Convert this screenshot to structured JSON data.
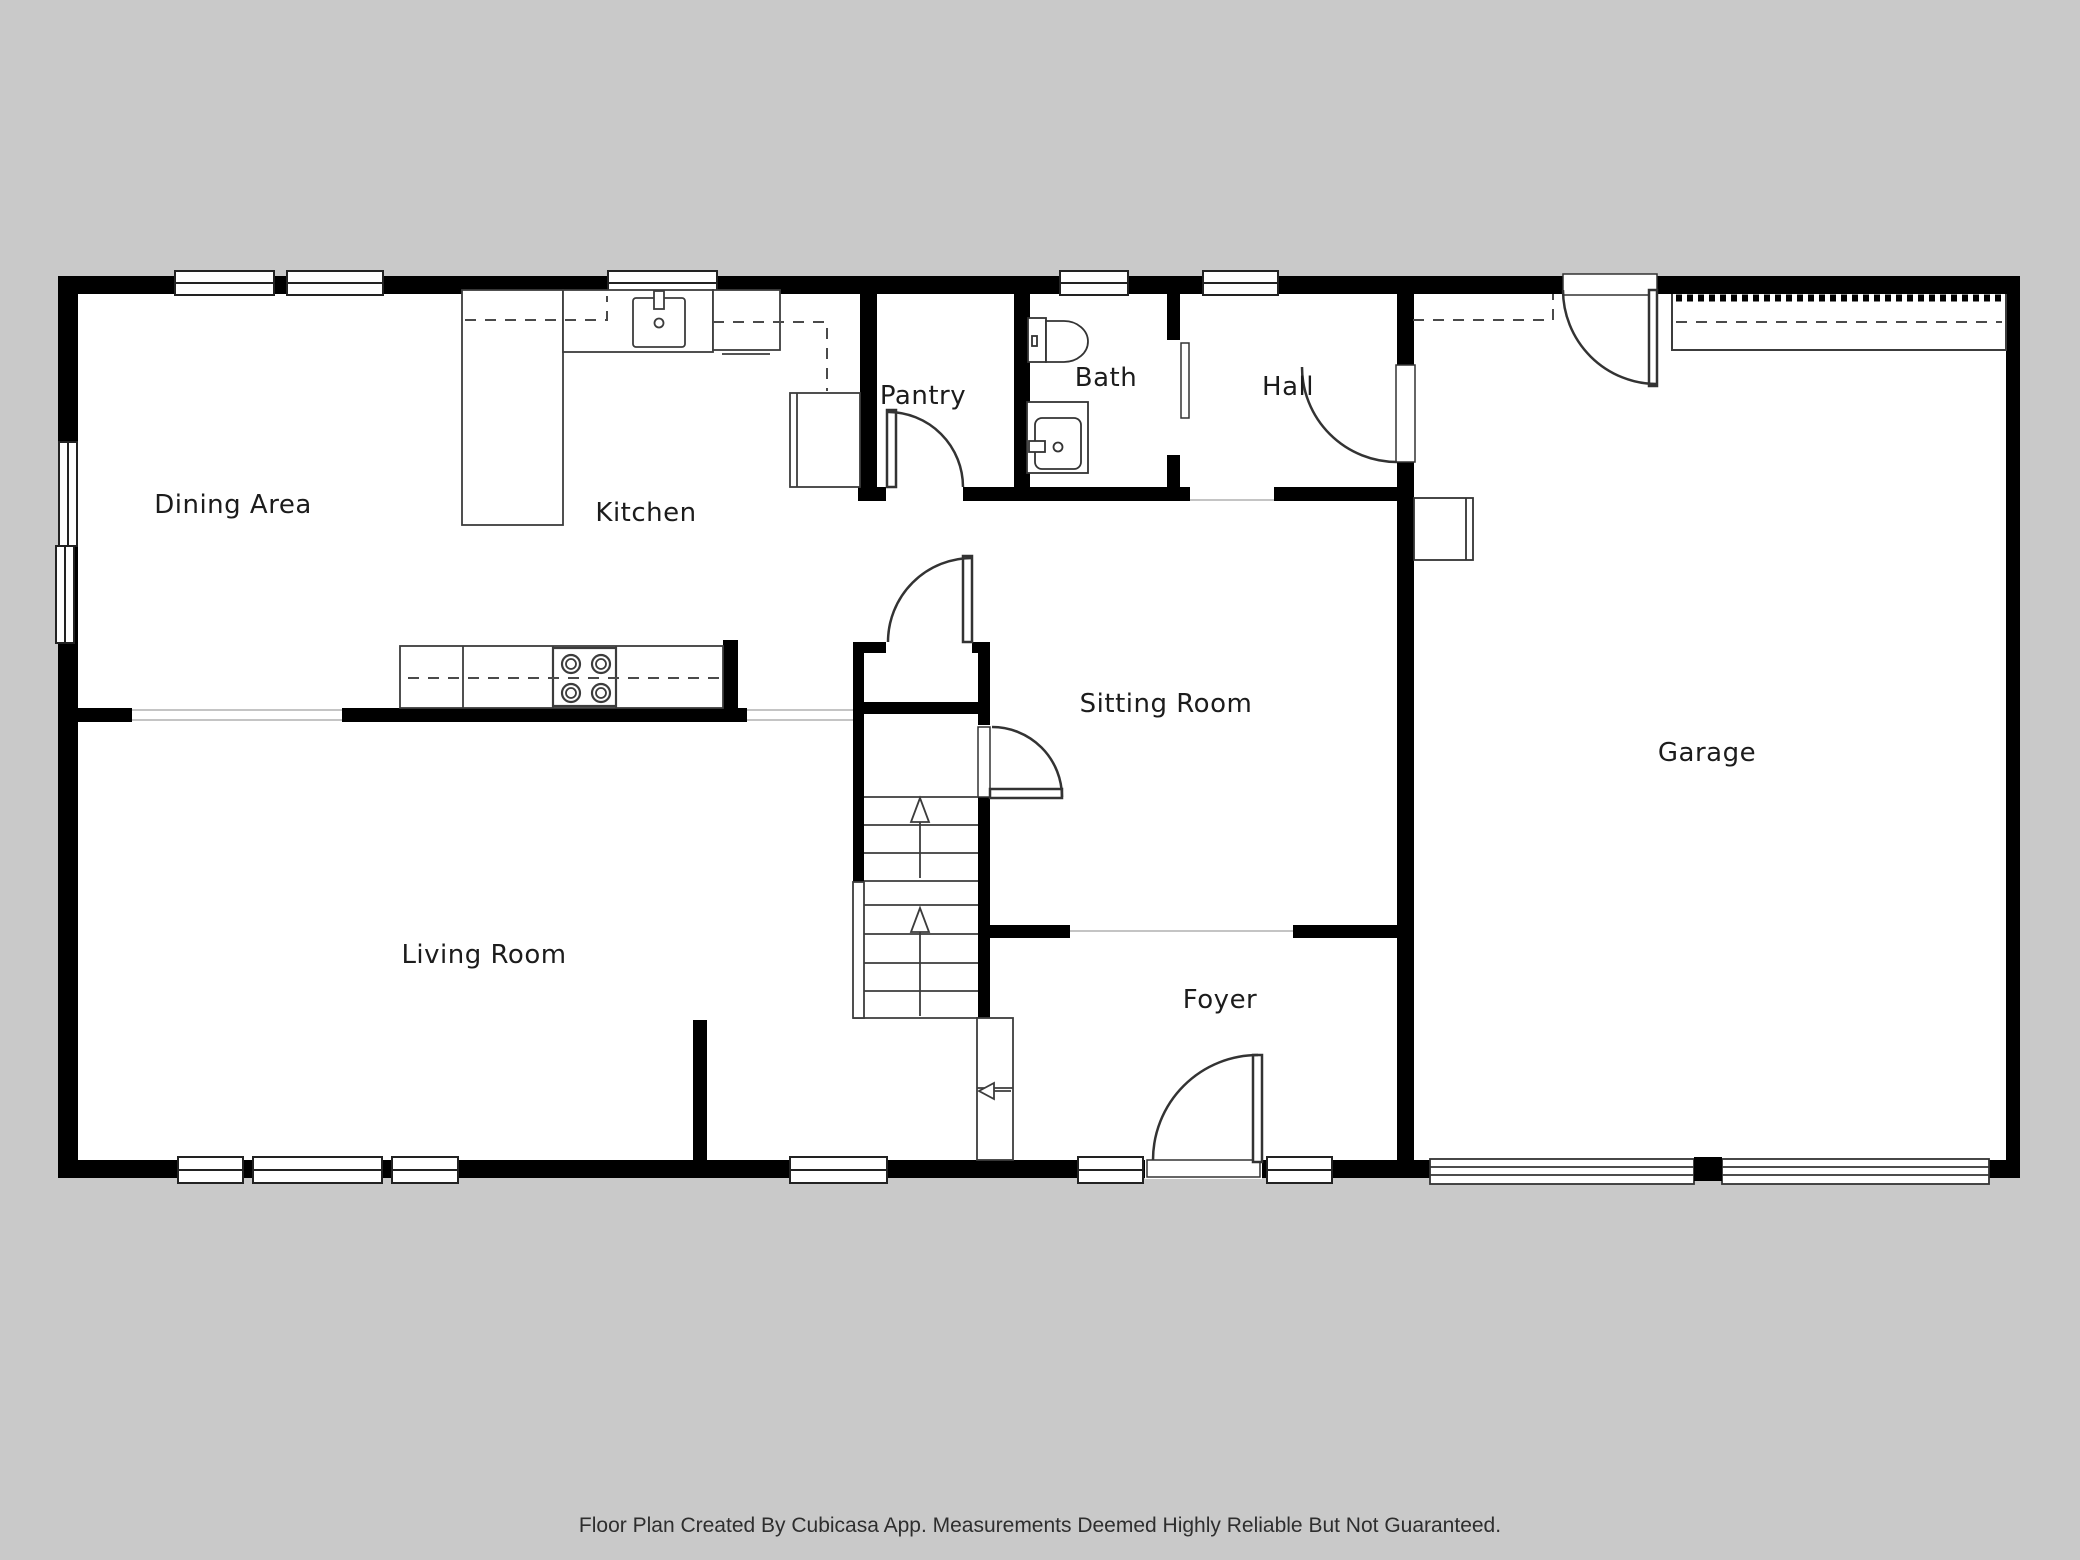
{
  "rooms": {
    "dining_area": {
      "label": "Dining Area"
    },
    "kitchen": {
      "label": "Kitchen"
    },
    "pantry": {
      "label": "Pantry"
    },
    "bath": {
      "label": "Bath"
    },
    "hall": {
      "label": "Hall"
    },
    "sitting_room": {
      "label": "Sitting Room"
    },
    "garage": {
      "label": "Garage"
    },
    "living_room": {
      "label": "Living Room"
    },
    "foyer": {
      "label": "Foyer"
    }
  },
  "footer": {
    "text": "Floor Plan Created By Cubicasa App. Measurements Deemed Highly Reliable But Not Guaranteed."
  },
  "colors": {
    "background": "#c9c9c9",
    "floor": "#ffffff",
    "wall": "#000000",
    "fixture_line": "#3c3c3c",
    "opening_line": "#c4c4c4",
    "label_text": "#1c1c1c"
  },
  "fixtures": [
    "kitchen-sink",
    "stove-burners",
    "refrigerator",
    "kitchen-island",
    "pantry-door",
    "toilet",
    "bathroom-vanity",
    "sliding-door",
    "staircase",
    "up-arrows",
    "entry-arrow",
    "front-door-with-sidelites",
    "interior-doors",
    "garage-overhead-doors",
    "water-heater",
    "windows"
  ]
}
